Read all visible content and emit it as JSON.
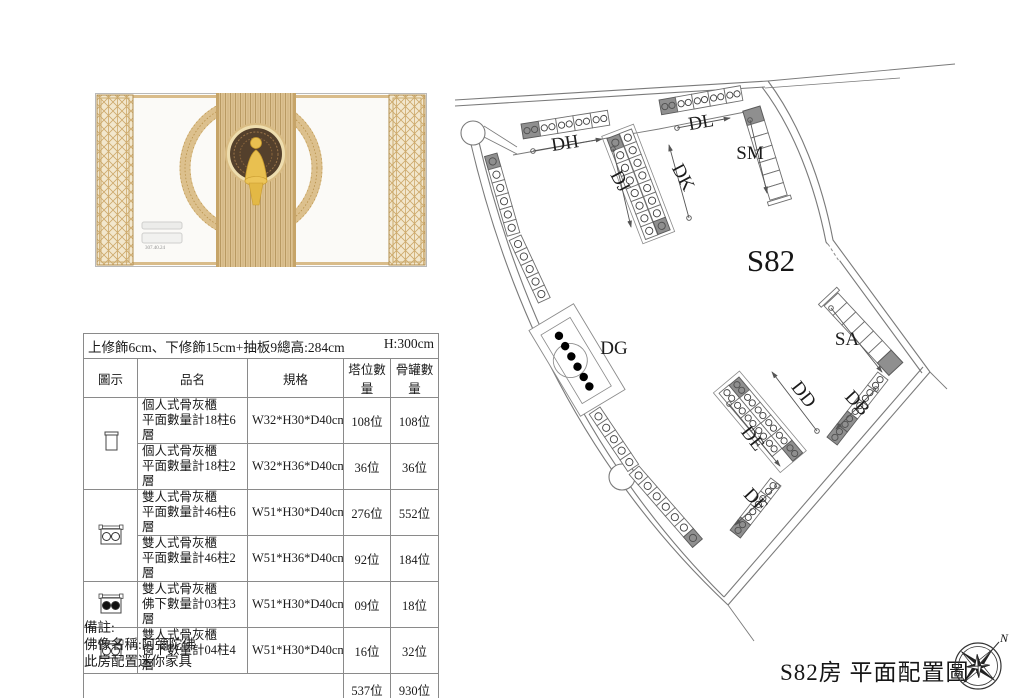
{
  "render": {
    "description": "altar-elevation-render",
    "dimension_label": "307.40.24"
  },
  "spec_header": {
    "line": "上修飾6cm、下修飾15cm+抽板9總高:284cm",
    "height_note": "H:300cm"
  },
  "table": {
    "columns": [
      "圖示",
      "品名",
      "規格",
      "塔位數量",
      "骨罐數量"
    ],
    "rows": [
      {
        "icon": "single-cabinet",
        "name1": "個人式骨灰櫃",
        "name2": "平面數量計18柱6層",
        "spec": "W32*H30*D40cm",
        "slots": "108位",
        "urns": "108位"
      },
      {
        "icon": null,
        "name1": "個人式骨灰櫃",
        "name2": "平面數量計18柱2層",
        "spec": "W32*H36*D40cm",
        "slots": "36位",
        "urns": "36位"
      },
      {
        "icon": "double-cabinet-open",
        "name1": "雙人式骨灰櫃",
        "name2": "平面數量計46柱6層",
        "spec": "W51*H30*D40cm",
        "slots": "276位",
        "urns": "552位"
      },
      {
        "icon": null,
        "name1": "雙人式骨灰櫃",
        "name2": "平面數量計46柱2層",
        "spec": "W51*H36*D40cm",
        "slots": "92位",
        "urns": "184位"
      },
      {
        "icon": "double-cabinet-filled",
        "name1": "雙人式骨灰櫃",
        "name2": "佛下數量計03柱3層",
        "spec": "W51*H30*D40cm",
        "slots": "09位",
        "urns": "18位"
      },
      {
        "icon": "double-cabinet-open2",
        "name1": "雙人式骨灰櫃",
        "name2": "窗下數量計04柱4層",
        "spec": "W51*H30*D40cm",
        "slots": "16位",
        "urns": "32位"
      }
    ],
    "total": {
      "slots": "537位",
      "urns": "930位"
    }
  },
  "notes": [
    "備註:",
    "佛像名稱:阿彌陀佛",
    "此房配置迷你家具"
  ],
  "plan": {
    "room_label": "S82",
    "zones": [
      {
        "id": "dh",
        "label": "DH"
      },
      {
        "id": "dl",
        "label": "DL"
      },
      {
        "id": "sm",
        "label": "SM"
      },
      {
        "id": "dj",
        "label": "DJ"
      },
      {
        "id": "dk",
        "label": "DK"
      },
      {
        "id": "dg",
        "label": "DG"
      },
      {
        "id": "sa",
        "label": "SA"
      },
      {
        "id": "dd",
        "label": "DD"
      },
      {
        "id": "de",
        "label": "DE"
      },
      {
        "id": "db",
        "label": "DB"
      },
      {
        "id": "df",
        "label": "DF"
      }
    ],
    "compass_north": "N"
  },
  "footer": {
    "title": "S82房 平面配置圖"
  }
}
